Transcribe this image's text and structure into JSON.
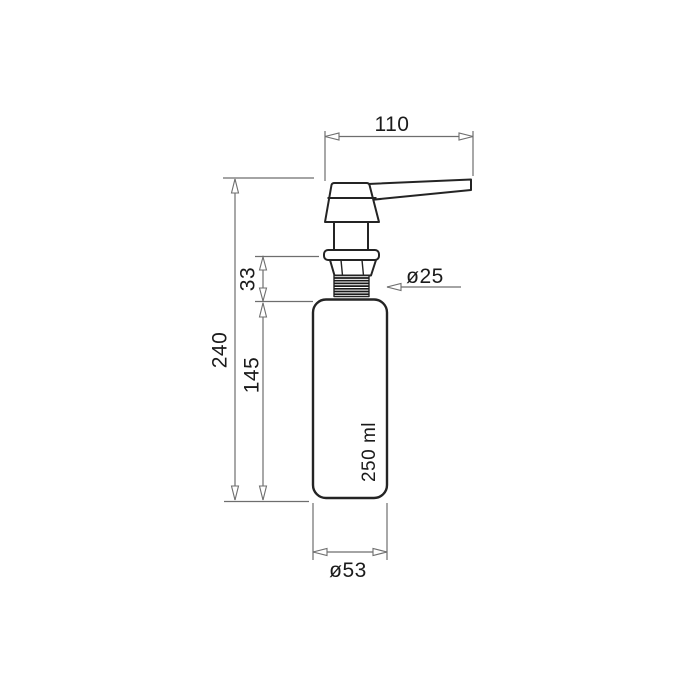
{
  "page": {
    "background_color": "#ffffff"
  },
  "drawing": {
    "subject": "soap-dispenser-pump-and-bottle-technical-drawing",
    "colors": {
      "outline": "#242424",
      "dimension_line": "#6e6e6e",
      "label_text": "#1b1b1b",
      "background": "#ffffff"
    },
    "labels": {
      "spout_width_mm": "110",
      "total_height_mm": "240",
      "neck_section_mm": "33",
      "bottle_height_mm": "145",
      "thread_diameter": "ø25",
      "bottle_diameter": "ø53",
      "capacity": "250 ml"
    }
  }
}
